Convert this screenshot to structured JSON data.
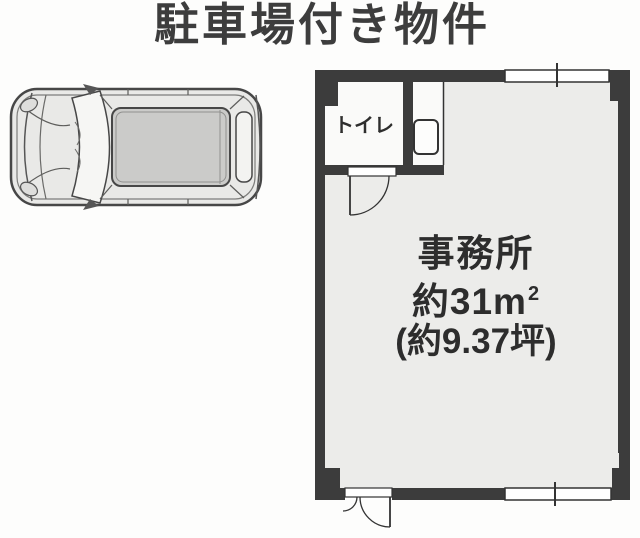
{
  "title": {
    "text": "駐車場付き物件"
  },
  "floor_plan": {
    "toilet": {
      "label": "トイレ"
    },
    "office": {
      "name": "事務所",
      "area_sqm_text": "約31m",
      "area_sqm_sup": "2",
      "area_tsubo_text": "(約9.37坪)"
    },
    "symbols": [
      "sliding-window-top",
      "sliding-window-bottom",
      "toilet-door-swing",
      "entrance-door-swing",
      "washbasin-fixture"
    ],
    "colors": {
      "wall": "#3c3c3c",
      "office_floor": "#ececea",
      "toilet_floor": "#fafaf9",
      "outline": "#2f2f2f",
      "text": "#2d2d2d"
    }
  },
  "car": {
    "description": "car-top-view-parked"
  }
}
